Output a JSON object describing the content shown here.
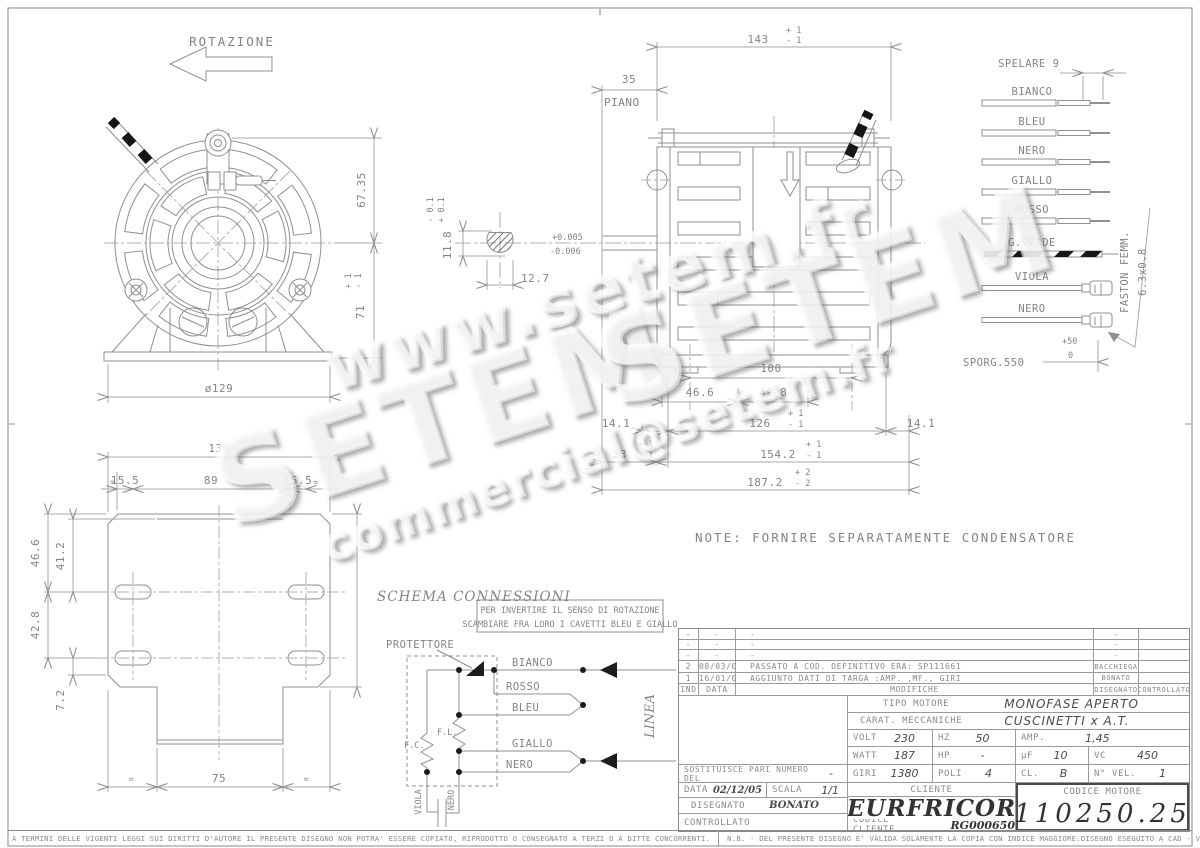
{
  "colors": {
    "line": "#8a8a8a",
    "text": "#848484",
    "dark": "#4a4a4a",
    "black": "#1c1c1c"
  },
  "watermarks": {
    "url": "www.setem.fr",
    "brand": "SETEM",
    "brand2": "SETEM",
    "email": "commercial@setem.fr"
  },
  "front_view": {
    "rotazione": "ROTAZIONE",
    "dim_67_35": "67.35",
    "dim_71": "71",
    "tol_71_plus": "+ 1",
    "tol_71_minus": "- 1",
    "dia_129": "ø129"
  },
  "shaft": {
    "dim_11_8": "11.8",
    "tol_plus": "+ 0.1",
    "tol_minus": "- 0.1",
    "dim_12_7": "12.7",
    "fit_plus": "+0.005",
    "fit_minus": "-0.006"
  },
  "side_view": {
    "dim_35": "35",
    "piano": "PIANO",
    "dim_143": "143",
    "tol_143_plus": "+ 1",
    "tol_143_minus": "- 1",
    "dim_100": "100",
    "dim_46_6": "46.6",
    "dim_42_8": "42.8",
    "dim_14_1_left": "14.1",
    "dim_126": "126",
    "tol_126_plus": "+ 1",
    "tol_126_minus": "- 1",
    "dim_14_1_right": "14.1",
    "dim_33": "33",
    "tol_33_plus": "+ 1",
    "tol_33_minus": "- 1",
    "dim_154_2": "154.2",
    "tol_154_plus": "+ 1",
    "tol_154_minus": "- 1",
    "dim_187_2": "187.2",
    "tol_187_plus": "+ 2",
    "tol_187_minus": "- 2"
  },
  "plate_view": {
    "dim_136": "136",
    "eq": "=",
    "dim_15_5_left": "15.5",
    "dim_89": "89",
    "dim_15_5_right": "15.5",
    "dim_46_6": "46.6",
    "dim_41_2": "41.2",
    "dim_42_8": "42.8",
    "dim_7_2": "7.2",
    "dim_75": "75"
  },
  "wires": {
    "spelare": "SPELARE 9",
    "w1": "BIANCO",
    "w2": "BLEU",
    "w3": "NERO",
    "w4": "GIALLO",
    "w5": "ROSSO",
    "w6": "G.VERDE",
    "w7": "VIOLA",
    "w8": "NERO",
    "sporg": "SPORG.550",
    "sporg_plus": "+50",
    "sporg_zero": "0",
    "faston": "FASTON FEMM.",
    "faston_size": "6.3x0.8"
  },
  "note": "NOTE: FORNIRE SEPARATAMENTE CONDENSATORE",
  "schema": {
    "title": "SCHEMA CONNESSIONI",
    "box_line1": "PER INVERTIRE IL SENSO DI ROTAZIONE",
    "box_line2": "SCAMBIARE FRA LORO I CAVETTI BLEU E GIALLO",
    "protettore": "PROTETTORE",
    "bianco": "BIANCO",
    "rosso": "ROSSO",
    "bleu": "BLEU",
    "giallo": "GIALLO",
    "nero": "NERO",
    "fc": "F.C.",
    "fl": "F.L.",
    "viola": "VIOLA",
    "nero2": "NERO",
    "linea": "LINEA"
  },
  "title_block": {
    "revisions": [
      {
        "ind": "-",
        "date": "-",
        "text": "-",
        "drawn": "-",
        "checked": ""
      },
      {
        "ind": "-",
        "date": "-",
        "text": "-",
        "drawn": "-",
        "checked": ""
      },
      {
        "ind": "-",
        "date": "-",
        "text": "-",
        "drawn": "-",
        "checked": ""
      },
      {
        "ind": "2",
        "date": "08/03/06",
        "text": "PASSATO A COD. DEFINITIVO ERA: SP111661",
        "drawn": "BACCHIEGA",
        "checked": ""
      },
      {
        "ind": "1",
        "date": "16/01/06",
        "text": "AGGIUNTO DATI DI TARGA :AMP. ,MF., GIRI",
        "drawn": "BONATO",
        "checked": ""
      }
    ],
    "headers": {
      "ind": "IND",
      "data": "DATA",
      "modifiche": "MODIFICHE",
      "disegnato": "DISEGNATO",
      "controllato": "CONTROLLATO"
    },
    "tipo_label": "TIPO MOTORE",
    "tipo_value": "MONOFASE APERTO",
    "carat_label": "CARAT. MECCANICHE",
    "carat_value": "CUSCINETTI x A.T.",
    "volt_label": "VOLT",
    "volt": "230",
    "hz_label": "HZ",
    "hz": "50",
    "amp_label": "AMP.",
    "amp": "1,45",
    "watt_label": "WATT",
    "watt": "187",
    "hp_label": "HP",
    "hp": "-",
    "uf_label": "µF",
    "uf": "10",
    "vc_label": "VC",
    "vc": "450",
    "giri_label": "GIRI",
    "giri": "1380",
    "poli_label": "POLI",
    "poli": "4",
    "cl_label": "CL.",
    "cl": "B",
    "nvel_label": "N° VEL.",
    "nvel": "1",
    "sost_label": "SOSTITUISCE PARI NUMERO DEL",
    "sost_value": "-",
    "data_label": "DATA",
    "data_value": "02/12/05",
    "scala_label": "SCALA",
    "scala_value": "1/1",
    "disegnato_label": "DISEGNATO",
    "disegnato_value": "BONATO",
    "controllato_label": "CONTROLLATO",
    "cliente_label": "CLIENTE",
    "cliente_value": "EURFRICOR",
    "cod_cliente_label": "CODICE CLIENTE",
    "cod_cliente_value": "RG000650",
    "cod_motore_label": "CODICE MOTORE",
    "cod_motore_value": "110250.25"
  },
  "footer": {
    "left": "A TERMINI DELLE VIGENTI LEGGI SUI DIRITTI D'AUTORE IL PRESENTE DISEGNO NON POTRA' ESSERE COPIATO, RIPRODOTTO O CONSEGNATO A TERZI O A DITTE CONCORRENTI.",
    "nb": "N.B. - DEL PRESENTE DISEGNO E' VALIDA SOLAMENTE LA COPIA CON INDICE MAGGIORE.",
    "cad": "DISEGNO ESEGUITO A CAD - VIETATA LA MODIFICA MANUALE"
  }
}
